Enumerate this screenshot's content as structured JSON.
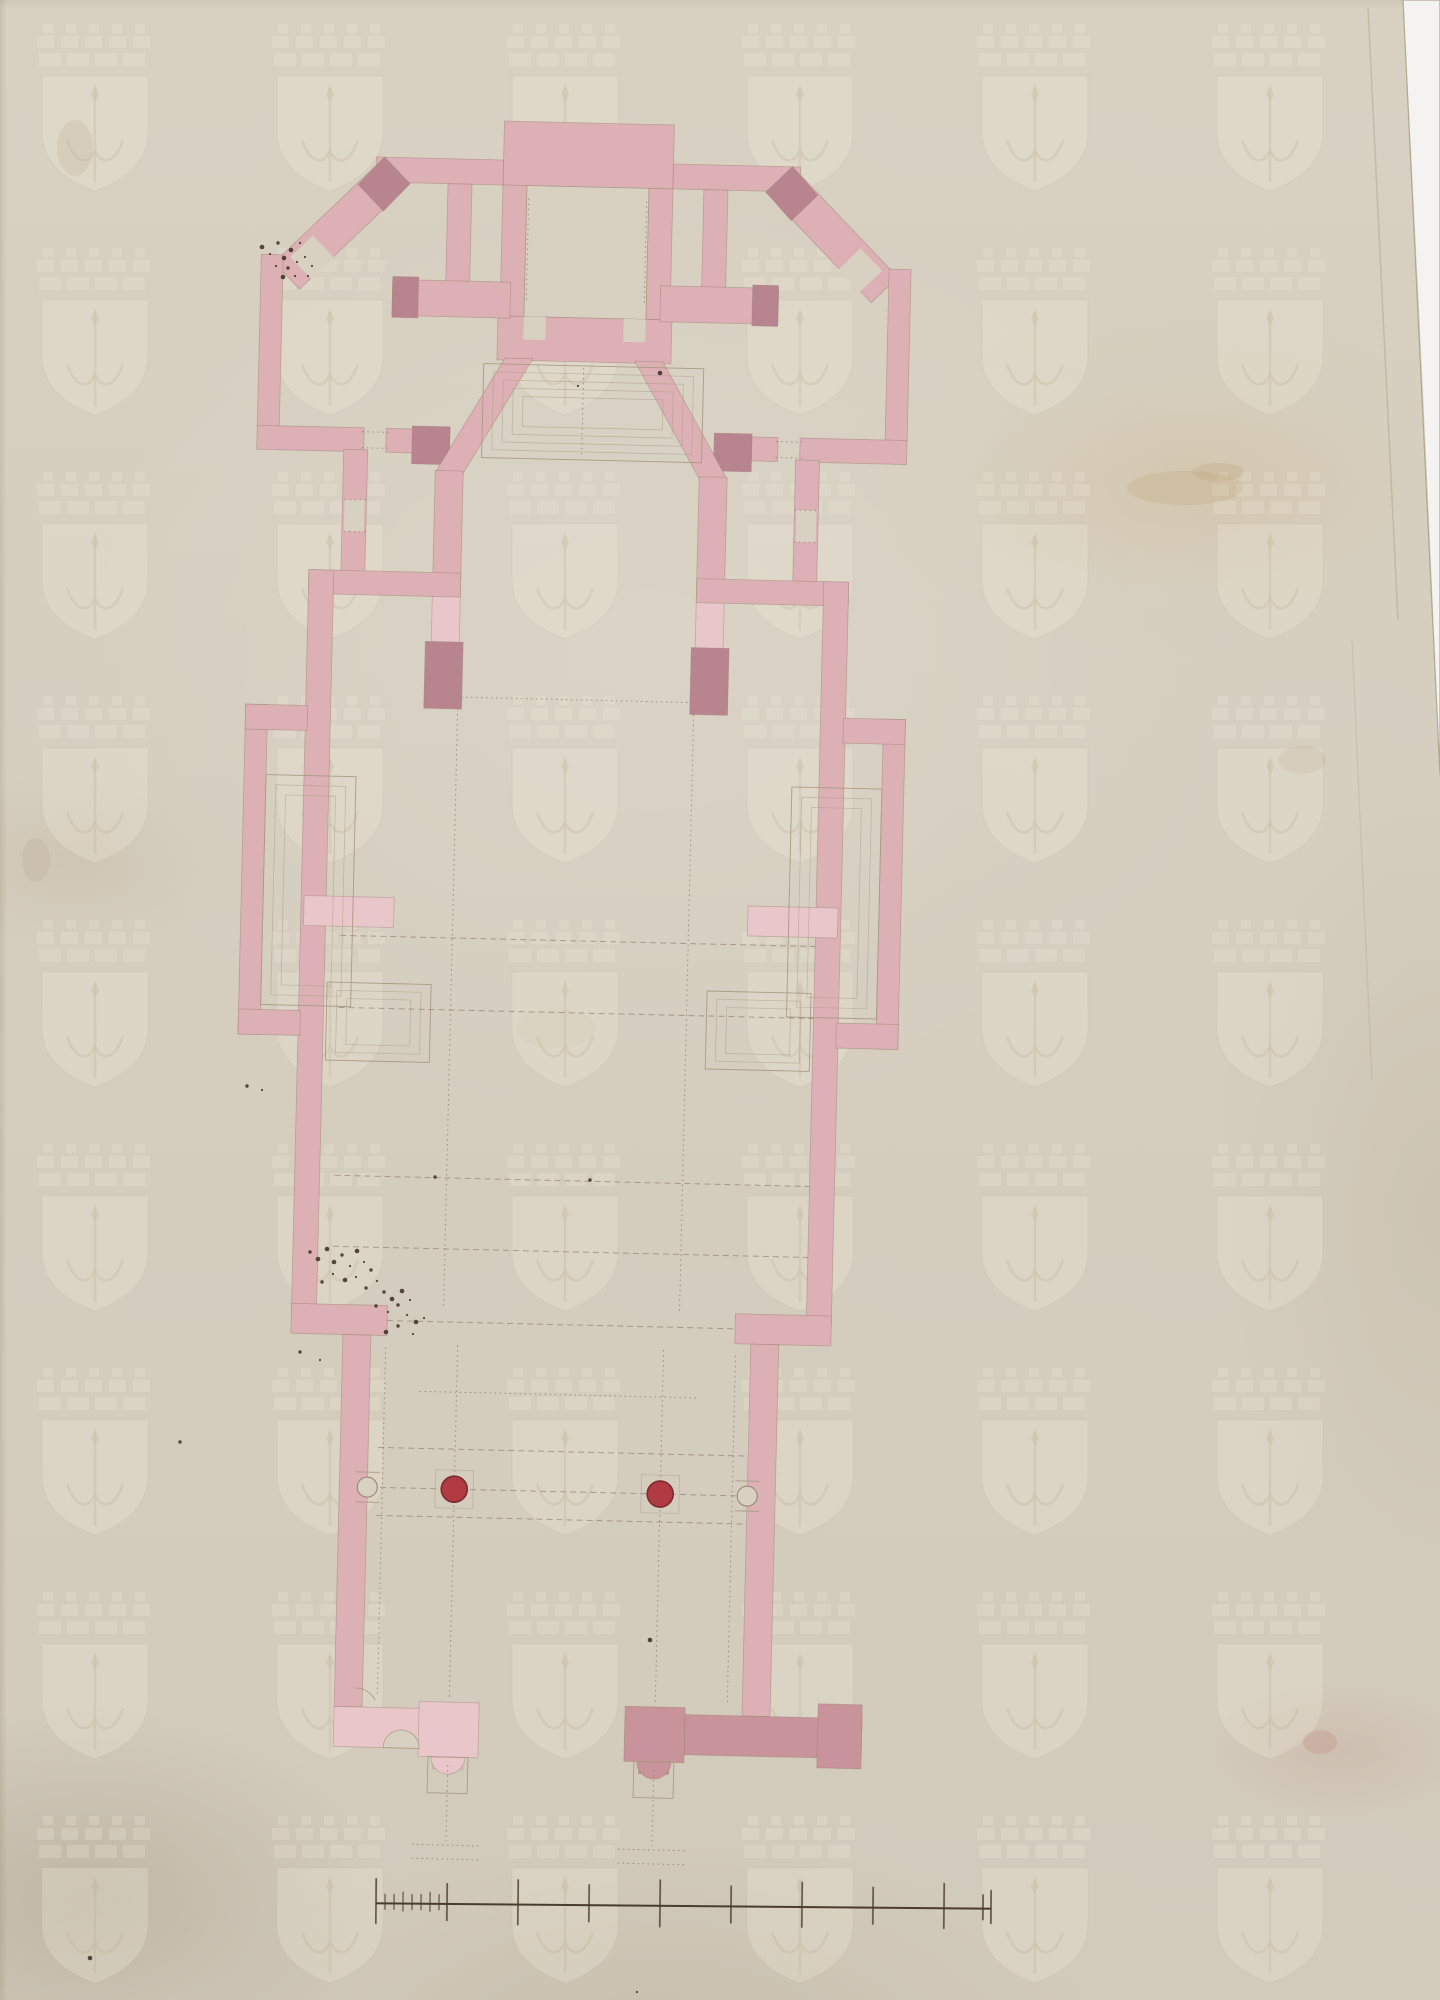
{
  "colors": {
    "paper": "#d8d1c2",
    "paper_dark_tone": "#d2cabb",
    "scan_background": "#f4f3f1",
    "wall_pink": "#ddb0b6",
    "wall_pink_light": "#e8c6ca",
    "wall_pink_dark": "#c9939c",
    "wall_pink_deep": "#b8848f",
    "wall_edge": "#997f6f",
    "line_faint": "#ab9c85",
    "line_dash": "#8d7c67",
    "column_red": "#b03b42",
    "column_red_dark": "#7c2b31",
    "ink": "#3b2d1f",
    "scalebar_ink": "#4a3c2c",
    "watermark_fill": "#efe9da",
    "watermark_line": "#c6bba2"
  },
  "watermark": {
    "motif": "shield-with-halberd-under-mural-crown-watermark",
    "columns_x": [
      95,
      330,
      565,
      800,
      1035,
      1270
    ],
    "rows_y": [
      24,
      248,
      472,
      696,
      920,
      1144,
      1368,
      1592,
      1816
    ]
  },
  "colonnade": {
    "free_columns": [
      {
        "cx": 467,
        "cy": 1492
      },
      {
        "cx": 673,
        "cy": 1492
      }
    ],
    "free_radius": 13,
    "engaged_columns": [
      {
        "cx": 380,
        "cy": 1492
      },
      {
        "cx": 760,
        "cy": 1492
      }
    ],
    "engaged_radius": 10,
    "portal_columns": [
      {
        "cx": 467,
        "cy": 1760
      },
      {
        "cx": 673,
        "cy": 1760
      }
    ],
    "free_column_count": 2
  },
  "scale_bar": {
    "y": 1906,
    "x_start": 376,
    "x_end": 991,
    "major_ticks": [
      {
        "x": 376,
        "h": 46
      },
      {
        "x": 447,
        "h": 38
      },
      {
        "x": 518,
        "h": 46
      },
      {
        "x": 589,
        "h": 38
      },
      {
        "x": 660,
        "h": 48
      },
      {
        "x": 731,
        "h": 38
      },
      {
        "x": 802,
        "h": 46
      },
      {
        "x": 873,
        "h": 38
      },
      {
        "x": 944,
        "h": 46
      },
      {
        "x": 983,
        "h": 26
      },
      {
        "x": 991,
        "h": 34
      }
    ],
    "minor_ticks": [
      {
        "x": 385,
        "h": 16
      },
      {
        "x": 394,
        "h": 16
      },
      {
        "x": 403,
        "h": 20
      },
      {
        "x": 412,
        "h": 16
      },
      {
        "x": 421,
        "h": 16
      },
      {
        "x": 430,
        "h": 20
      },
      {
        "x": 439,
        "h": 16
      }
    ]
  },
  "ink_speckles": {
    "cluster_diagonal_door": [
      [
        262,
        247
      ],
      [
        270,
        254
      ],
      [
        278,
        243
      ],
      [
        284,
        258
      ],
      [
        291,
        250
      ],
      [
        297,
        262
      ],
      [
        288,
        268
      ],
      [
        276,
        266
      ],
      [
        305,
        257
      ],
      [
        300,
        243
      ],
      [
        312,
        266
      ],
      [
        295,
        276
      ],
      [
        283,
        277
      ],
      [
        308,
        276
      ]
    ],
    "cluster_nave_left": [
      [
        310,
        1252
      ],
      [
        318,
        1259
      ],
      [
        327,
        1249
      ],
      [
        334,
        1262
      ],
      [
        342,
        1255
      ],
      [
        350,
        1266
      ],
      [
        357,
        1251
      ],
      [
        364,
        1262
      ],
      [
        371,
        1270
      ],
      [
        356,
        1277
      ],
      [
        345,
        1280
      ],
      [
        333,
        1274
      ],
      [
        322,
        1282
      ],
      [
        366,
        1288
      ],
      [
        377,
        1281
      ],
      [
        384,
        1292
      ],
      [
        392,
        1299
      ],
      [
        402,
        1291
      ],
      [
        398,
        1305
      ],
      [
        410,
        1300
      ],
      [
        388,
        1312
      ],
      [
        376,
        1306
      ],
      [
        407,
        1315
      ],
      [
        416,
        1322
      ],
      [
        398,
        1326
      ],
      [
        386,
        1332
      ],
      [
        424,
        1318
      ],
      [
        413,
        1334
      ]
    ],
    "stray": [
      [
        247,
        1086
      ],
      [
        262,
        1090
      ],
      [
        180,
        1442
      ],
      [
        435,
        1177
      ],
      [
        590,
        1180
      ],
      [
        300,
        1352
      ],
      [
        320,
        1360
      ],
      [
        650,
        1640
      ],
      [
        637,
        1992
      ],
      [
        90,
        1958
      ],
      [
        660,
        373
      ],
      [
        578,
        386
      ]
    ]
  }
}
